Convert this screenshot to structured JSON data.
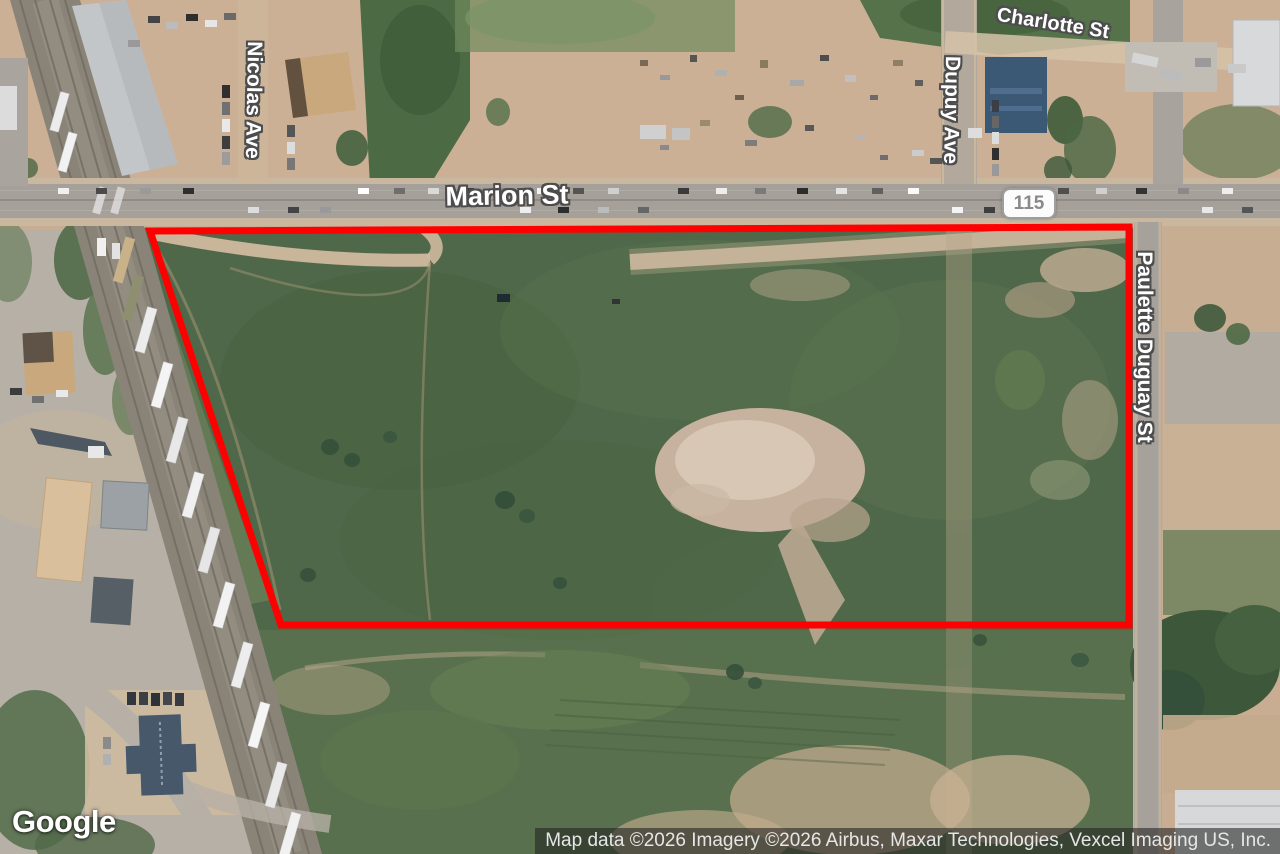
{
  "map": {
    "labels": {
      "charlotte": "Charlotte St",
      "nicolas": "Nicolas Ave",
      "marion": "Marion St",
      "dupuy": "Dupuy Ave",
      "paulette_duguay": "Paulette Duguay St",
      "route_shield": "115"
    },
    "overlay": {
      "parcel_boundary_color": "#ff0000"
    },
    "google_logo": "Google",
    "attribution": "Map data ©2026 Imagery ©2026 Airbus, Maxar Technologies, Vexcel Imaging US, Inc."
  }
}
